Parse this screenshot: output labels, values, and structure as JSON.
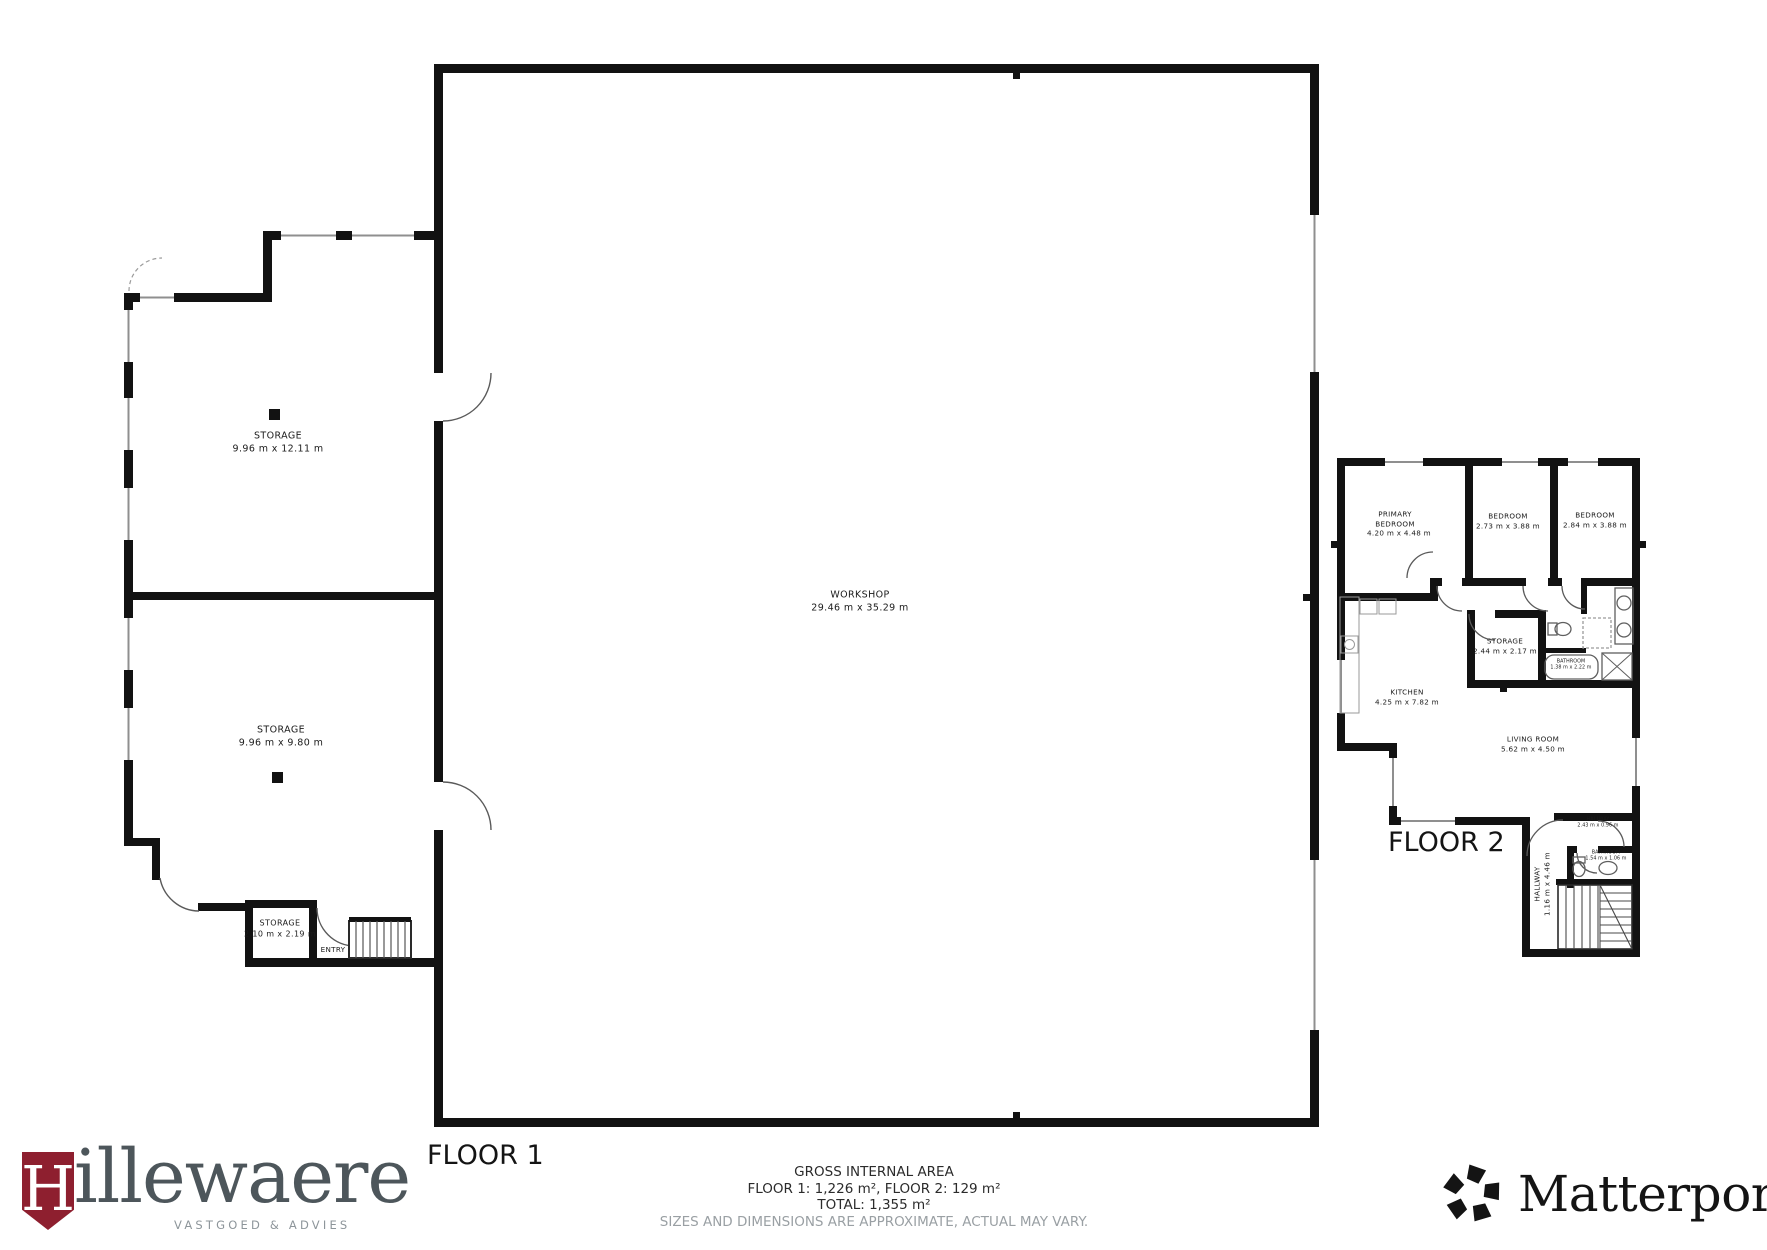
{
  "floor1": {
    "title": "FLOOR 1",
    "rooms": {
      "storage_top": {
        "name": "STORAGE",
        "dims": "9.96 m x 12.11 m"
      },
      "storage_bottom": {
        "name": "STORAGE",
        "dims": "9.96 m x 9.80 m"
      },
      "workshop": {
        "name": "WORKSHOP",
        "dims": "29.46 m x 35.29 m"
      },
      "storage_small": {
        "name": "STORAGE",
        "dims": "2.10 m x 2.19 m"
      },
      "entry": {
        "name": "ENTRY"
      }
    }
  },
  "floor2": {
    "title": "FLOOR 2",
    "rooms": {
      "primary_bedroom": {
        "name": "PRIMARY BEDROOM",
        "dims": "4.20 m x 4.48 m"
      },
      "bedroom_middle": {
        "name": "BEDROOM",
        "dims": "2.73 m x 3.88 m"
      },
      "bedroom_right": {
        "name": "BEDROOM",
        "dims": "2.84 m x 3.88 m"
      },
      "storage": {
        "name": "STORAGE",
        "dims": "2.44 m x 2.17 m"
      },
      "bathroom": {
        "name": "BATHROOM",
        "dims": "1.38 m x 2.22 m"
      },
      "kitchen": {
        "name": "KITCHEN",
        "dims": "4.25 m x 7.82 m"
      },
      "living_room": {
        "name": "LIVING ROOM",
        "dims": "5.62 m x 4.50 m"
      },
      "hall": {
        "name": "HALLWAY",
        "dims": "2.43 m x 0.96 m"
      },
      "bathroom_small": {
        "name": "BATHROOM",
        "dims": "1.54 m x 1.06 m"
      },
      "hallway": {
        "name": "HALLWAY",
        "dims": "1.16 m x 4.46 m"
      }
    }
  },
  "footer": {
    "title": "GROSS INTERNAL AREA",
    "areas": "FLOOR 1: 1,226 m², FLOOR 2: 129 m²",
    "total": "TOTAL: 1,355 m²",
    "disclaimer": "SIZES AND DIMENSIONS ARE APPROXIMATE, ACTUAL MAY VARY."
  },
  "branding": {
    "hillewaere": {
      "initial": "H",
      "name": "illewaere",
      "tagline": "VASTGOED & ADVIES",
      "shield_color": "#8e1f2f",
      "text_color": "#4d565b"
    },
    "matterport": {
      "name": "Matterport",
      "registered": "®",
      "color": "#141414"
    }
  }
}
